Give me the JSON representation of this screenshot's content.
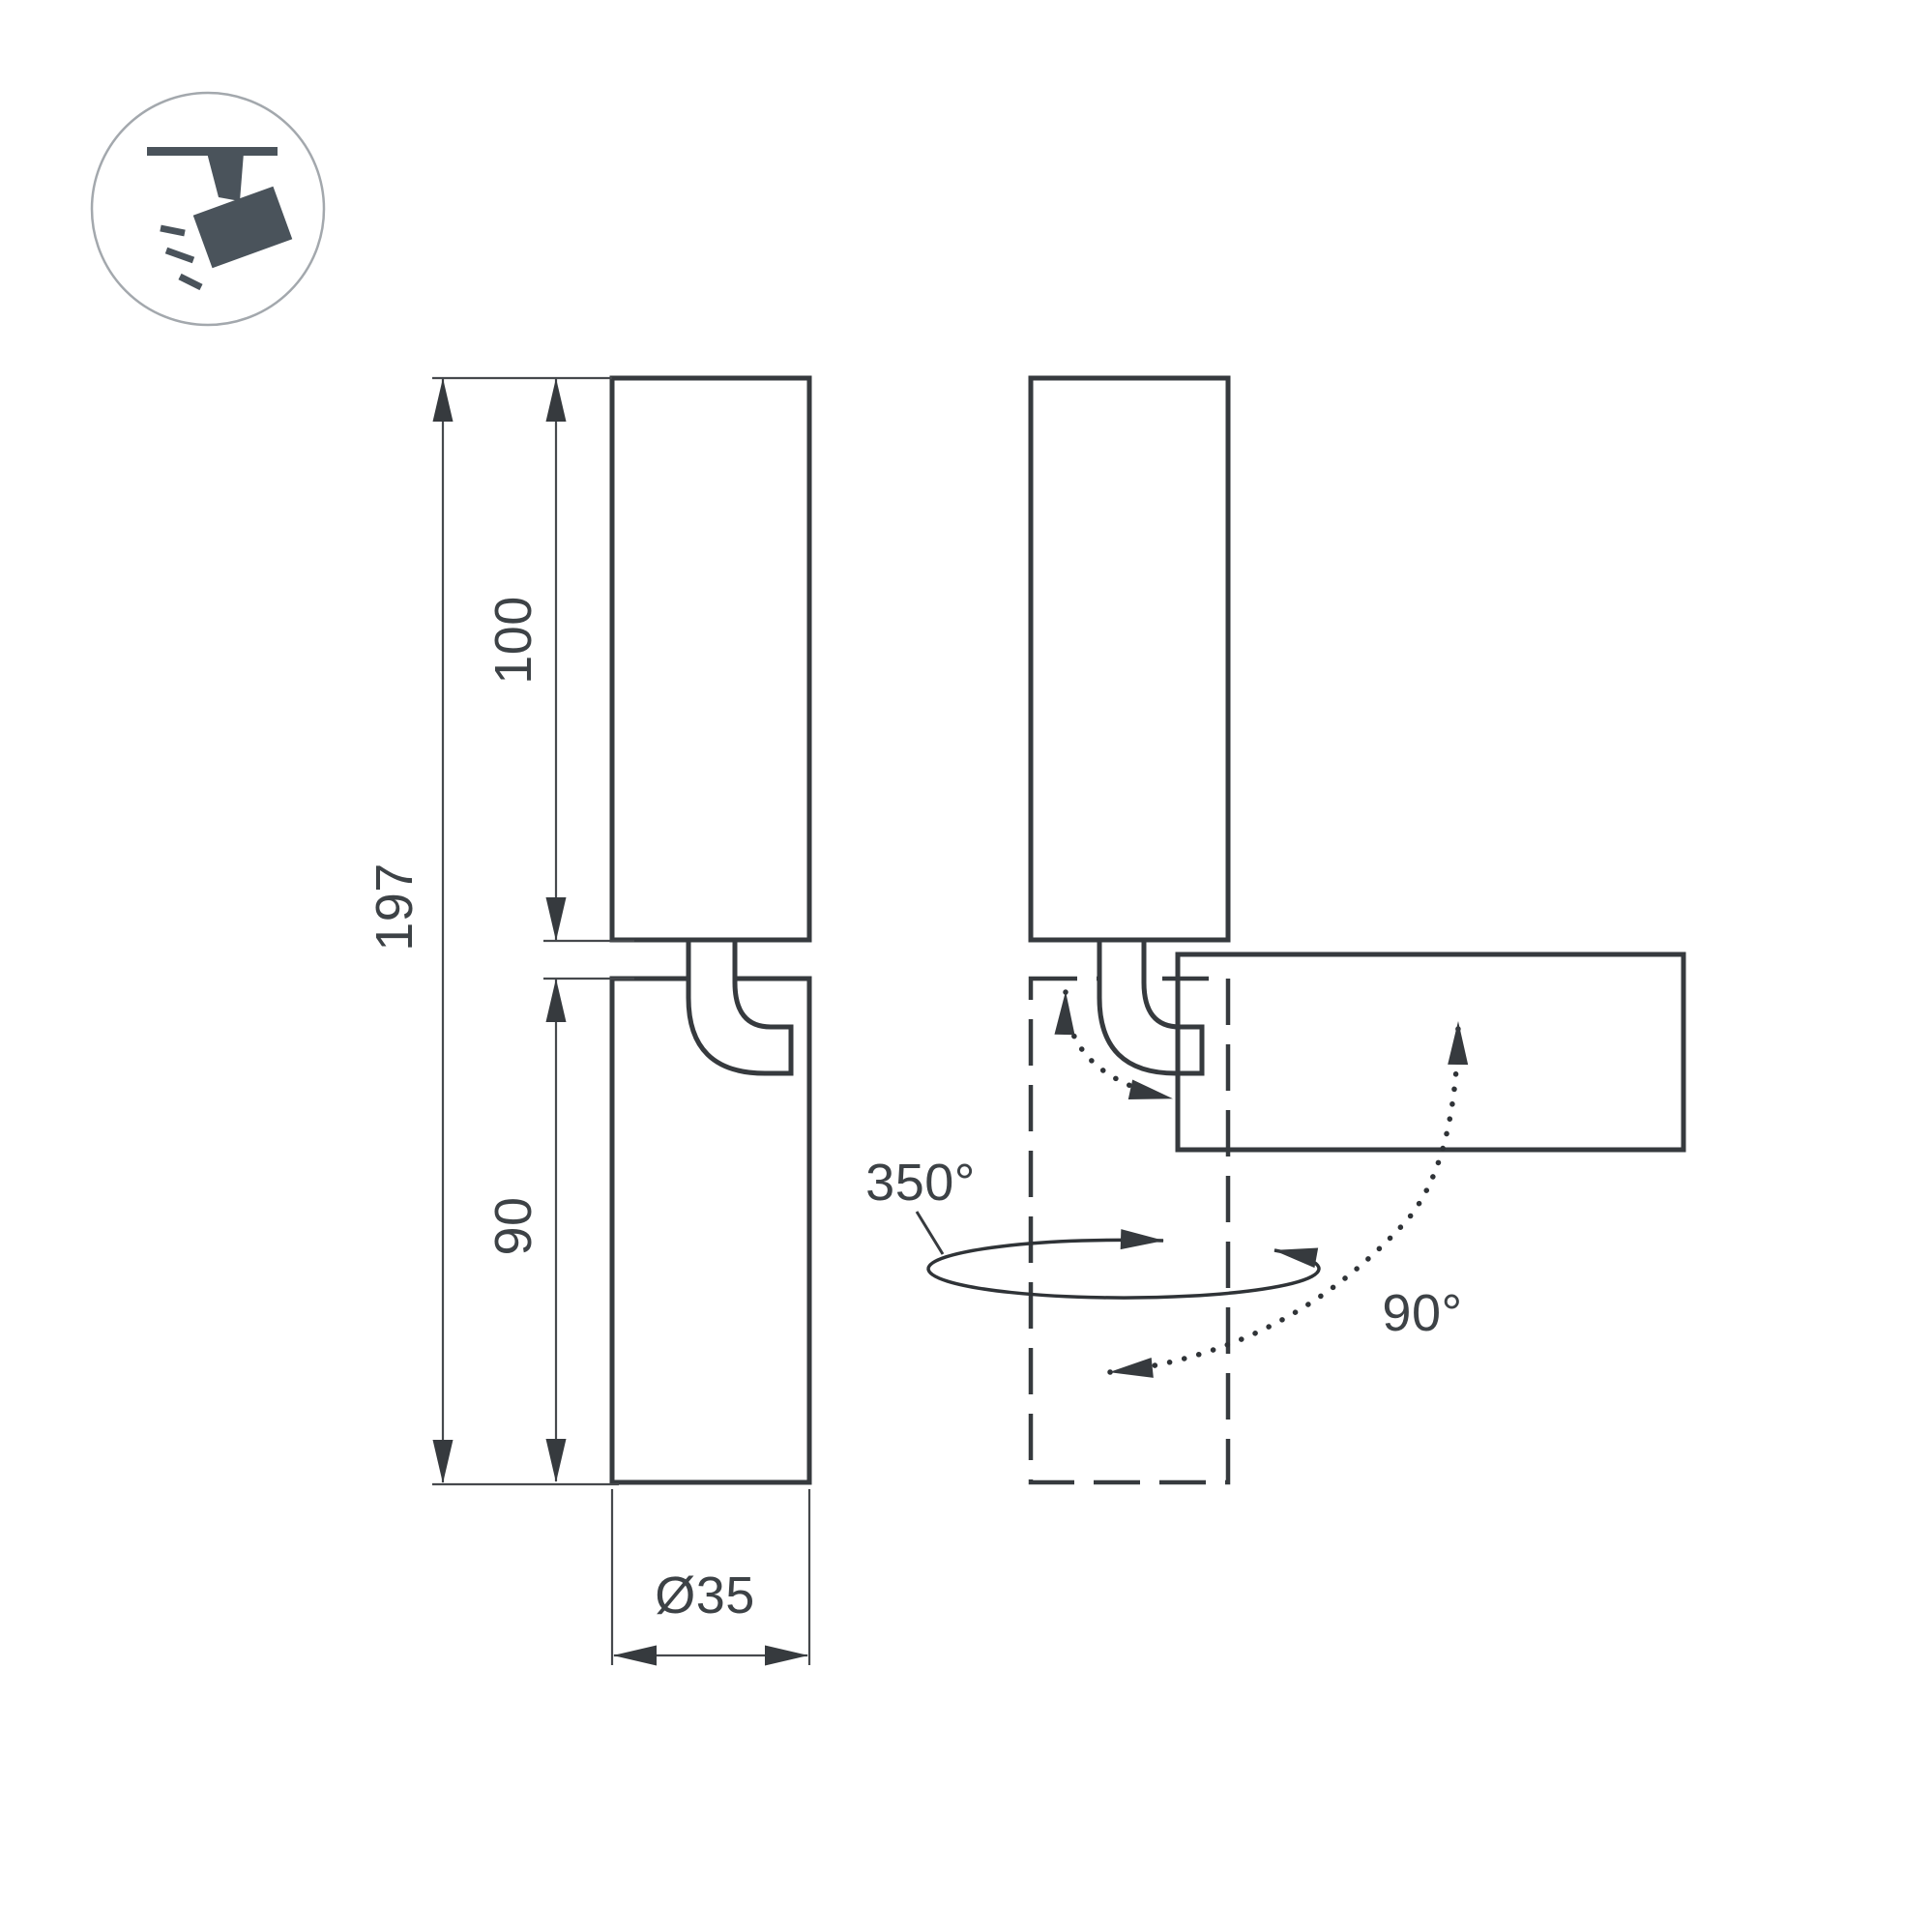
{
  "title": "Track spotlight dimension and rotation diagram",
  "colors": {
    "background": "#ffffff",
    "line": "#363a3e",
    "text": "#3d4246",
    "icon": "#4a535b",
    "icon_circle_outline": "#a3a8ad"
  },
  "icon": {
    "name": "track-spotlight-icon",
    "meaning": "ceiling track mounted adjustable spotlight"
  },
  "dimensions": {
    "total_height": "197",
    "upper_body_height": "100",
    "lower_body_height": "90",
    "diameter": "Ø35",
    "swivel_angle": "350°",
    "tilt_angle": "90°"
  }
}
